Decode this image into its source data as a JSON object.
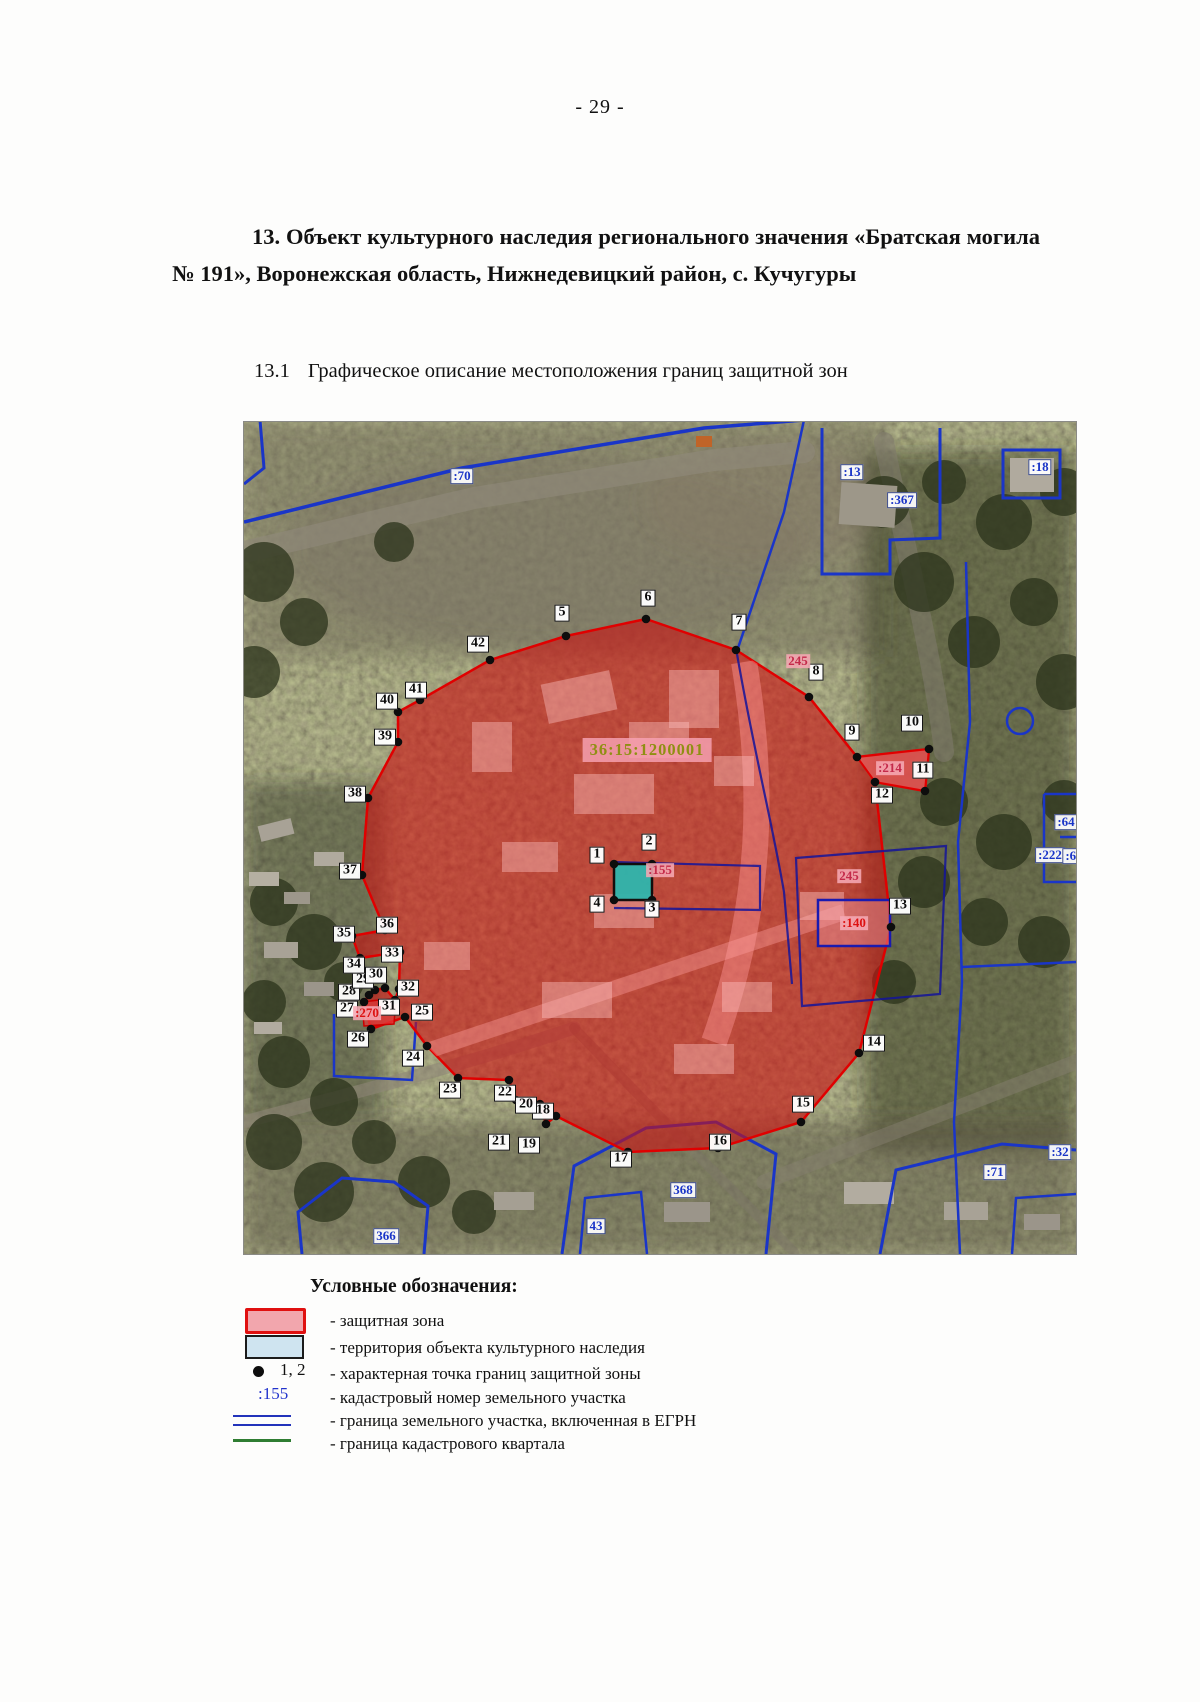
{
  "page": {
    "number": "- 29 -"
  },
  "heading": {
    "text": "13. Объект культурного наследия регионального значения «Братская могила № 191», Воронежская область, Нижнедевицкий район, с. Кучугуры"
  },
  "subheading": {
    "number": "13.1",
    "text": "Графическое описание местоположения границ защитной зон"
  },
  "map": {
    "quarter_label": "36:15:1200001",
    "point_labels": [
      {
        "t": "1",
        "x": 353,
        "y": 433
      },
      {
        "t": "2",
        "x": 405,
        "y": 420
      },
      {
        "t": "3",
        "x": 408,
        "y": 487
      },
      {
        "t": "4",
        "x": 353,
        "y": 482
      },
      {
        "t": "5",
        "x": 318,
        "y": 191
      },
      {
        "t": "6",
        "x": 404,
        "y": 176
      },
      {
        "t": "7",
        "x": 495,
        "y": 200
      },
      {
        "t": "8",
        "x": 572,
        "y": 250
      },
      {
        "t": "9",
        "x": 608,
        "y": 310
      },
      {
        "t": "10",
        "x": 668,
        "y": 301
      },
      {
        "t": "11",
        "x": 679,
        "y": 348
      },
      {
        "t": "12",
        "x": 638,
        "y": 373
      },
      {
        "t": "13",
        "x": 656,
        "y": 484
      },
      {
        "t": "14",
        "x": 630,
        "y": 621
      },
      {
        "t": "15",
        "x": 559,
        "y": 682
      },
      {
        "t": "16",
        "x": 476,
        "y": 720
      },
      {
        "t": "17",
        "x": 377,
        "y": 737
      },
      {
        "t": "18",
        "x": 299,
        "y": 689
      },
      {
        "t": "19",
        "x": 285,
        "y": 723
      },
      {
        "t": "20",
        "x": 282,
        "y": 683
      },
      {
        "t": "21",
        "x": 255,
        "y": 720
      },
      {
        "t": "22",
        "x": 261,
        "y": 671
      },
      {
        "t": "23",
        "x": 206,
        "y": 668
      },
      {
        "t": "24",
        "x": 169,
        "y": 636
      },
      {
        "t": "25",
        "x": 178,
        "y": 590
      },
      {
        "t": "26",
        "x": 114,
        "y": 617
      },
      {
        "t": "27",
        "x": 103,
        "y": 587
      },
      {
        "t": "28",
        "x": 105,
        "y": 570
      },
      {
        "t": "29",
        "x": 119,
        "y": 558
      },
      {
        "t": "30",
        "x": 132,
        "y": 553
      },
      {
        "t": "31",
        "x": 145,
        "y": 585
      },
      {
        "t": "32",
        "x": 164,
        "y": 566
      },
      {
        "t": "33",
        "x": 148,
        "y": 532
      },
      {
        "t": "34",
        "x": 110,
        "y": 543
      },
      {
        "t": "35",
        "x": 100,
        "y": 512
      },
      {
        "t": "36",
        "x": 143,
        "y": 503
      },
      {
        "t": "37",
        "x": 106,
        "y": 449
      },
      {
        "t": "38",
        "x": 111,
        "y": 372
      },
      {
        "t": "39",
        "x": 141,
        "y": 315
      },
      {
        "t": "40",
        "x": 143,
        "y": 279
      },
      {
        "t": "41",
        "x": 172,
        "y": 268
      },
      {
        "t": "42",
        "x": 234,
        "y": 222
      }
    ],
    "parcel_labels_blue": [
      {
        "t": ":70",
        "x": 218,
        "y": 54
      },
      {
        "t": ":13",
        "x": 608,
        "y": 50
      },
      {
        "t": ":367",
        "x": 658,
        "y": 78
      },
      {
        "t": ":18",
        "x": 796,
        "y": 45
      },
      {
        "t": ":64",
        "x": 822,
        "y": 400
      },
      {
        "t": ":222",
        "x": 806,
        "y": 433
      },
      {
        "t": ":63",
        "x": 830,
        "y": 434
      },
      {
        "t": ":32",
        "x": 816,
        "y": 730
      },
      {
        "t": ":71",
        "x": 751,
        "y": 750
      },
      {
        "t": "368",
        "x": 439,
        "y": 768
      },
      {
        "t": "43",
        "x": 352,
        "y": 804
      },
      {
        "t": "366",
        "x": 142,
        "y": 814
      }
    ],
    "parcel_labels_pink": [
      {
        "t": ":214",
        "x": 646,
        "y": 346
      },
      {
        "t": "245",
        "x": 554,
        "y": 239
      },
      {
        "t": "245",
        "x": 605,
        "y": 454
      },
      {
        "t": ":140",
        "x": 610,
        "y": 501,
        "v": "red"
      },
      {
        "t": ":155",
        "x": 416,
        "y": 448
      },
      {
        "t": ":270",
        "x": 123,
        "y": 591,
        "v": "red"
      }
    ]
  },
  "legend": {
    "title": "Условные обозначения:",
    "point_symbol": "1, 2",
    "cadastral_symbol": ":155",
    "items": [
      "-  защитная зона",
      "-  территория объекта культурного наследия",
      "- характерная точка границ защитной зоны",
      "- кадастровый номер земельного участка",
      "-  граница земельного участка, включенная в ЕГРН",
      "-  граница кадастрового квартала"
    ]
  },
  "colors": {
    "zone_fill": "#cc1111",
    "zone_stroke": "#e00000",
    "territory_teal": "#2fb5ad",
    "parcel_blue": "#1a35c8",
    "quarter_text_olive": "#8f8f12",
    "legend_green": "#2f7d32"
  }
}
